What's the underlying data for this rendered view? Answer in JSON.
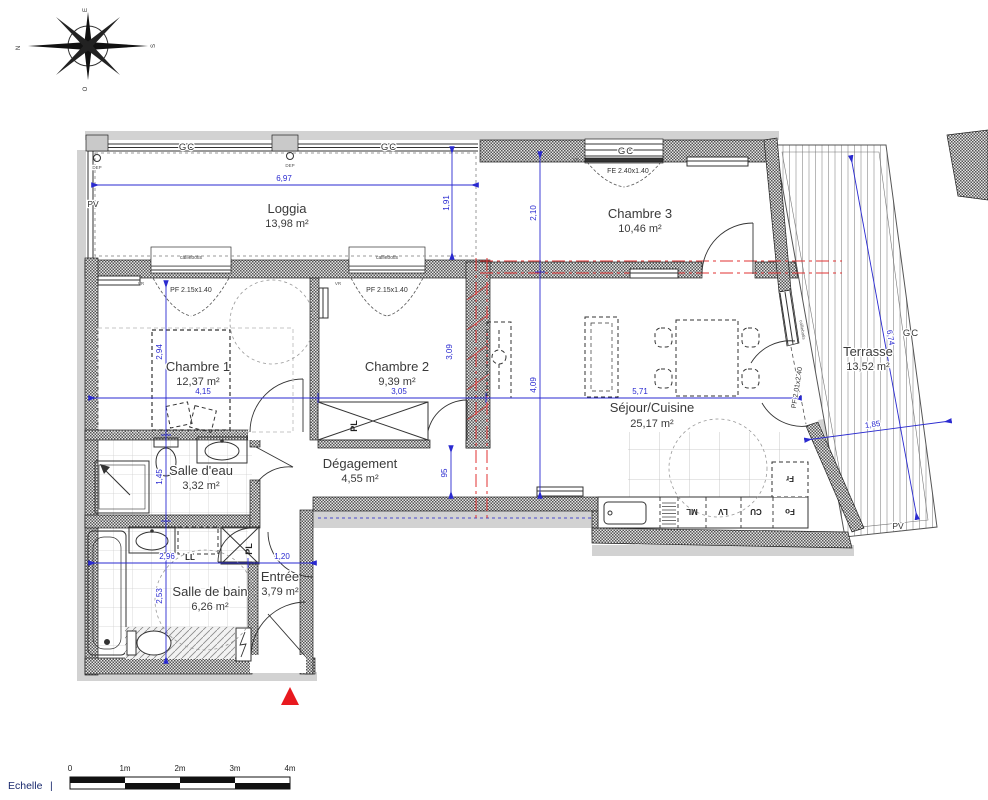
{
  "compass": {
    "north": "N",
    "east": "E",
    "south": "S",
    "west": "O"
  },
  "rooms": {
    "loggia": {
      "name": "Loggia",
      "area": "13,98 m²"
    },
    "chambre3": {
      "name": "Chambre 3",
      "area": "10,46 m²"
    },
    "terrasse": {
      "name": "Terrasse",
      "area": "13,52 m²"
    },
    "chambre1": {
      "name": "Chambre 1",
      "area": "12,37 m²"
    },
    "chambre2": {
      "name": "Chambre 2",
      "area": "9,39 m²"
    },
    "sejour": {
      "name": "Séjour/Cuisine",
      "area": "25,17 m²"
    },
    "salle_eau": {
      "name": "Salle d'eau",
      "area": "3,32 m²"
    },
    "degagement": {
      "name": "Dégagement",
      "area": "4,55 m²"
    },
    "salle_bain": {
      "name": "Salle de bain",
      "area": "6,26 m²"
    },
    "entree": {
      "name": "Entrée",
      "area": "3,79 m²"
    }
  },
  "dimensions": {
    "loggia_width": "6,97",
    "loggia_depth": "1,91",
    "chambre3_depth": "2,10",
    "chambre1_width": "4,15",
    "chambre1_depth": "2,94",
    "chambre2_width": "3,05",
    "chambre2_depth": "3,09",
    "sejour_width": "5,71",
    "sejour_depth": "4,09",
    "terrasse_length": "6,74",
    "terrasse_width": "1,85",
    "salle_eau_depth": "1,45",
    "salle_bain_width": "2,96",
    "salle_bain_depth": "2,53",
    "entree_width": "1,20",
    "passage_width": "95"
  },
  "openings": {
    "chambre1_window": "PF 2.15x1.40",
    "chambre2_window": "PF 2.15x1.40",
    "chambre3_window": "FE 2.40x1.40",
    "terrasse_door": "PF 2.01x2.40"
  },
  "labels": {
    "gc": "GC",
    "pv": "PV",
    "dep": "DEP",
    "vr": "VR",
    "caillebotis": "caillebotis",
    "placard": "PL",
    "lave_linge": "LL",
    "machine_laver": "ML",
    "lave_vaisselle": "LV",
    "cuisson": "CU",
    "four": "Fo",
    "frigo": "Fr"
  },
  "scale_bar": {
    "label": "Echelle",
    "tick_mark": "|",
    "ticks": [
      "0",
      "1m",
      "2m",
      "3m",
      "4m"
    ]
  }
}
